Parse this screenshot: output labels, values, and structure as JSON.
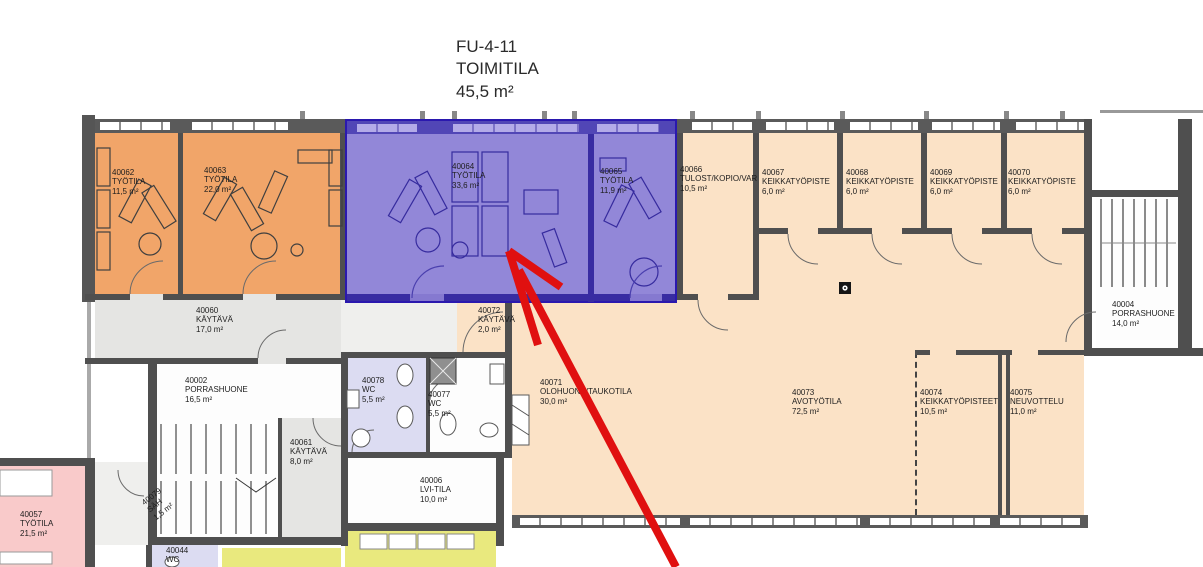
{
  "title": {
    "code": "FU-4-11",
    "name": "TOIMITILA",
    "area": "45,5 m²"
  },
  "rooms": {
    "r40062": {
      "id": "40062",
      "name": "TYÖTILA",
      "area": "11,5 m²"
    },
    "r40063": {
      "id": "40063",
      "name": "TYÖTILA",
      "area": "22,0 m²"
    },
    "r40064": {
      "id": "40064",
      "name": "TYÖTILA",
      "area": "33,6 m²"
    },
    "r40065": {
      "id": "40065",
      "name": "TYÖTILA",
      "area": "11,9 m²"
    },
    "r40066": {
      "id": "40066",
      "name": "TULOST/KOPIO/VAR",
      "area": "10,5 m²"
    },
    "r40067": {
      "id": "40067",
      "name": "KEIKKATYÖPISTE",
      "area": "6,0 m²"
    },
    "r40068": {
      "id": "40068",
      "name": "KEIKKATYÖPISTE",
      "area": "6,0 m²"
    },
    "r40069": {
      "id": "40069",
      "name": "KEIKKATYÖPISTE",
      "area": "6,0 m²"
    },
    "r40070": {
      "id": "40070",
      "name": "KEIKKATYÖPISTE",
      "area": "6,0 m²"
    },
    "r40004": {
      "id": "40004",
      "name": "PORRASHUONE",
      "area": "14,0 m²"
    },
    "r40060": {
      "id": "40060",
      "name": "KÄYTÄVÄ",
      "area": "17,0 m²"
    },
    "r40072": {
      "id": "40072",
      "name": "KÄYTÄVÄ",
      "area": "2,0 m²"
    },
    "r40002": {
      "id": "40002",
      "name": "PORRASHUONE",
      "area": "16,5 m²"
    },
    "r40078": {
      "id": "40078",
      "name": "WC",
      "area": "5,5 m²"
    },
    "r40077": {
      "id": "40077",
      "name": "WC",
      "area": "5,5 m²"
    },
    "r40071": {
      "id": "40071",
      "name": "OLOHUONE/TAUKOTILA",
      "area": "30,0 m²"
    },
    "r40073": {
      "id": "40073",
      "name": "AVOTYÖTILA",
      "area": "72,5 m²"
    },
    "r40074": {
      "id": "40074",
      "name": "KEIKKATYÖPISTEET",
      "area": "10,5 m²"
    },
    "r40075": {
      "id": "40075",
      "name": "NEUVOTTELU",
      "area": "11,0 m²"
    },
    "r40061": {
      "id": "40061",
      "name": "KÄYTÄVÄ",
      "area": "8,0 m²"
    },
    "r40006": {
      "id": "40006",
      "name": "LVI-TILA",
      "area": "10,0 m²"
    },
    "r40079": {
      "id": "40079",
      "name": "SÄH",
      "area": "1,5 m²"
    },
    "r40057": {
      "id": "40057",
      "name": "TYÖTILA",
      "area": "21,5 m²"
    },
    "r40044": {
      "id": "40044",
      "name": "WC",
      "area": ""
    }
  },
  "colors": {
    "highlight_purple": "#9287d8",
    "selection_border": "#2a18ae",
    "office_orange": "#f1a569",
    "base_beige": "#fbe2c6",
    "corridor_gray": "#e5e5e3",
    "wc_lavender": "#dcdcf2",
    "room_pink": "#f9caca",
    "room_yellow": "#e9e97e",
    "arrow_red": "#e01010"
  }
}
